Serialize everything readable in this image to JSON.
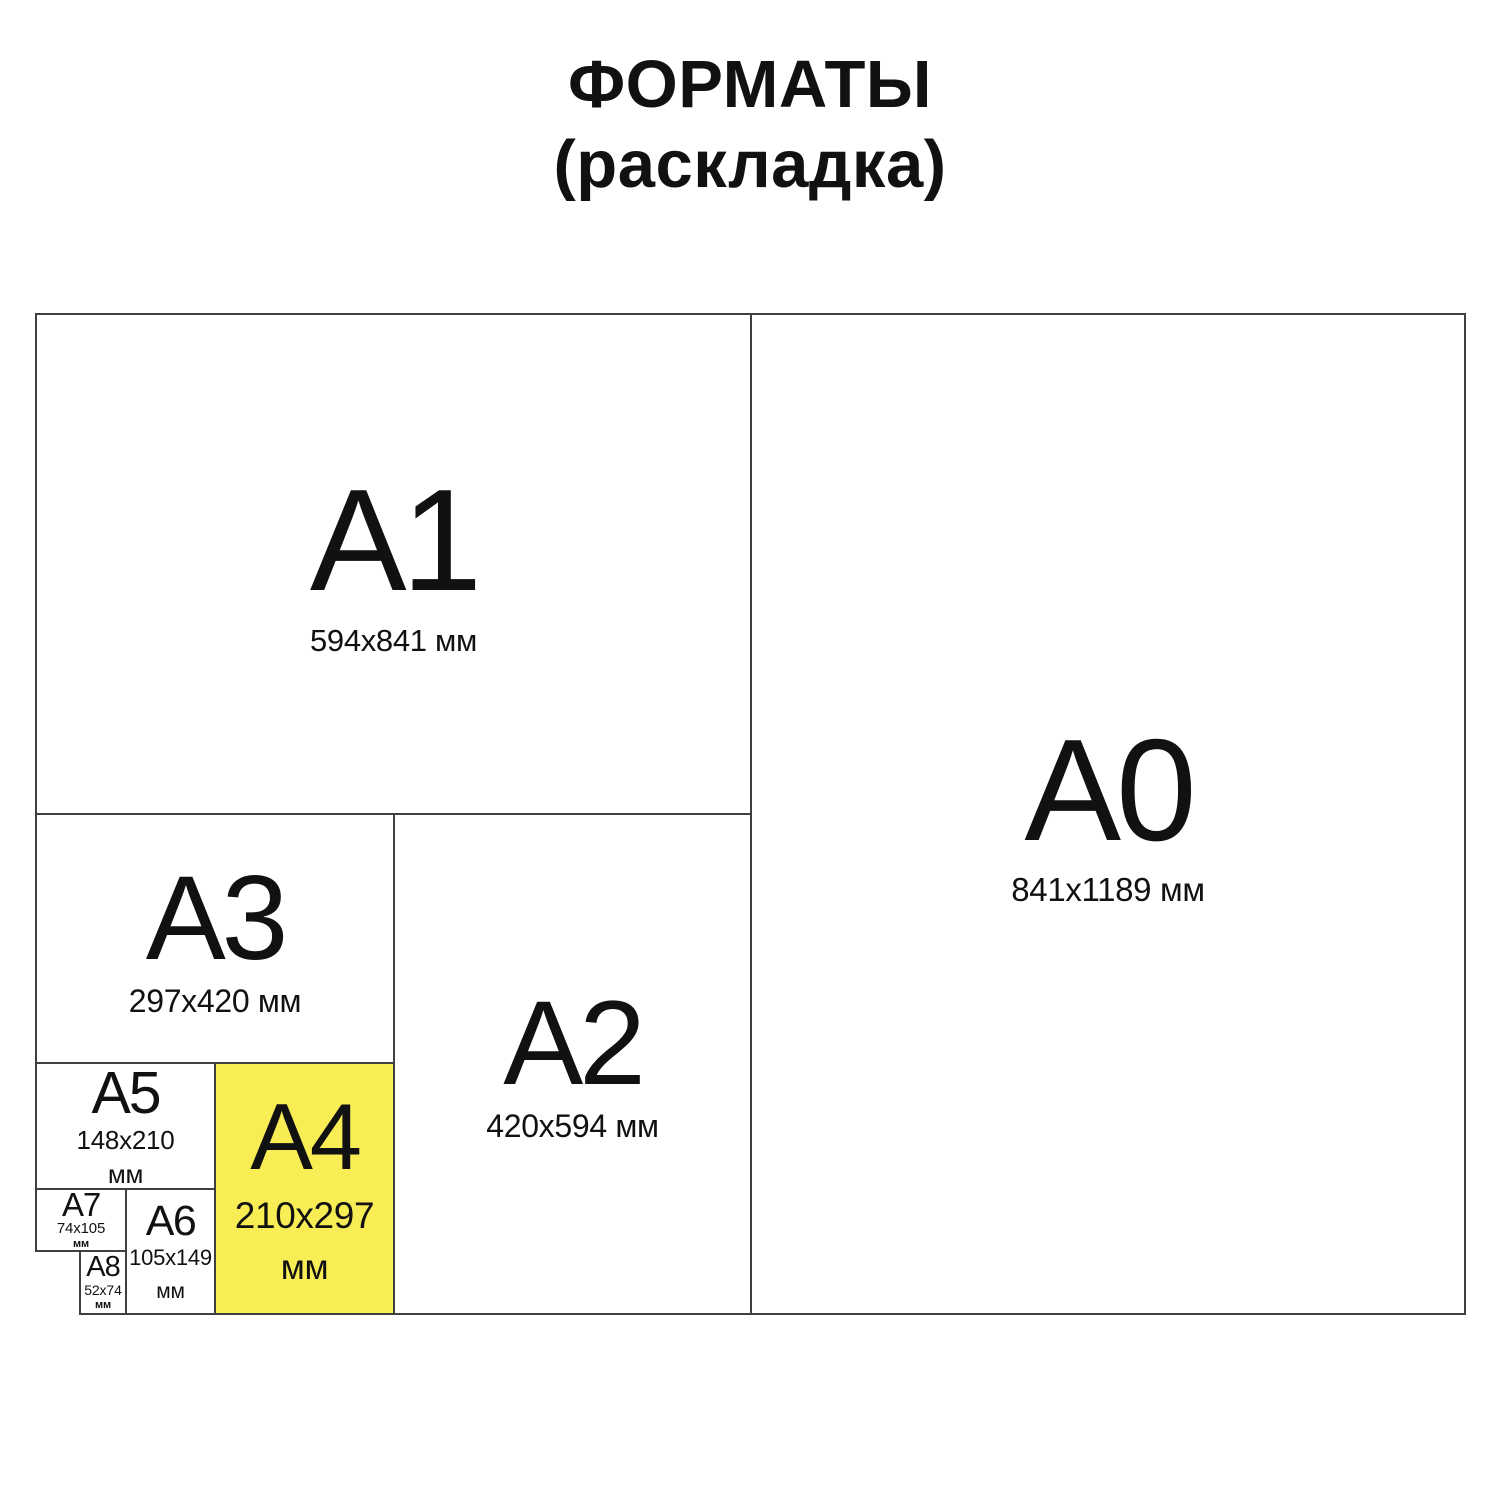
{
  "title": {
    "line1": "ФОРМАТЫ",
    "line2": "(раскладка)"
  },
  "colors": {
    "highlight": "#F8ED55",
    "line": "#3F3F3F",
    "ink": "#111111",
    "background": "#FFFFFF"
  },
  "formats": {
    "a0": {
      "label": "A0",
      "size": "841x1189 мм"
    },
    "a1": {
      "label": "A1",
      "size": "594x841 мм"
    },
    "a2": {
      "label": "A2",
      "size": "420x594 мм"
    },
    "a3": {
      "label": "A3",
      "size": "297x420 мм"
    },
    "a4": {
      "label": "A4",
      "size": "210x297",
      "unit": "мм"
    },
    "a5": {
      "label": "A5",
      "size": "148x210",
      "unit": "мм"
    },
    "a6": {
      "label": "A6",
      "size": "105x149",
      "unit": "мм"
    },
    "a7": {
      "label": "A7",
      "size": "74x105",
      "unit": "мм"
    },
    "a8": {
      "label": "A8",
      "size": "52x74",
      "unit": "мм"
    }
  }
}
